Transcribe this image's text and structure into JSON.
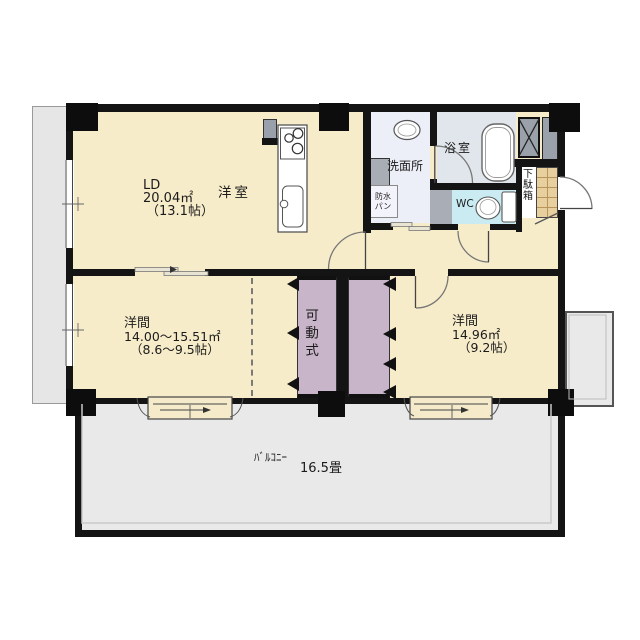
{
  "rooms": {
    "ld": {
      "abbr": "LD",
      "area": "20.04㎡",
      "tatami": "（13.1帖）",
      "type": "洋室"
    },
    "washroom": {
      "name": "洗面所"
    },
    "bathroom": {
      "name": "浴室"
    },
    "toilet": {
      "name": "WC"
    },
    "bedroom_left": {
      "name": "洋間",
      "area": "14.00～15.51㎡",
      "tatami": "（8.6～9.5帖）"
    },
    "bedroom_right": {
      "name": "洋間",
      "area": "14.96㎡",
      "tatami": "（9.2帖）"
    },
    "balcony": {
      "name": "ﾊﾞﾙｺﾆｰ",
      "size": "16.5畳"
    }
  },
  "features": {
    "partition": {
      "name": "可動式"
    },
    "shoe_cabinet": {
      "name": "下駄箱"
    },
    "laundry_pan": {
      "line1": "防水",
      "line2": "パン"
    }
  },
  "colors": {
    "wall": "#141414",
    "room_cream": "#f7ecca",
    "balcony_gray": "#e9e9e9",
    "partition_mauve": "#c9b5c9",
    "washroom_blue": "#eceff7",
    "bath_gray": "#e1e6ec",
    "wc_cyan": "#c9ebf1",
    "entrance_tan": "#e8cf9e",
    "fixture_gray": "#9ba1ab"
  }
}
